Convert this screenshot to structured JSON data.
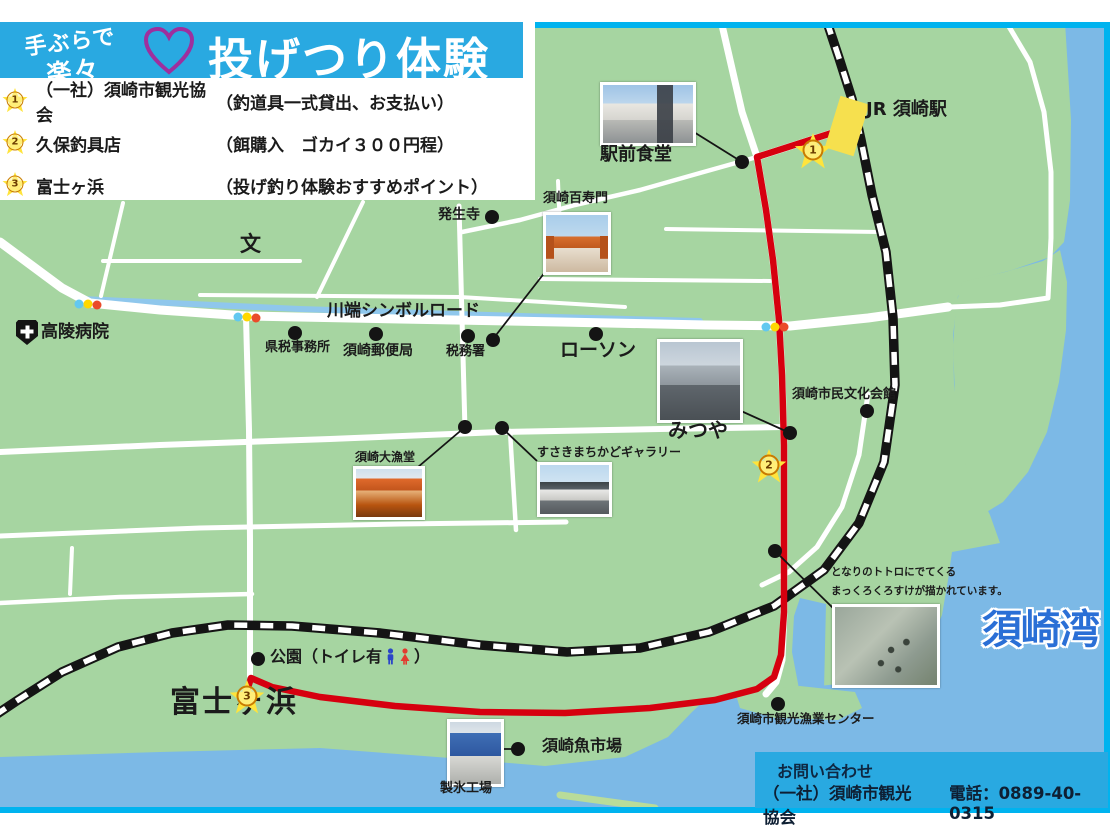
{
  "banner": {
    "tagline_line1": "手ぶらで",
    "tagline_line2": "楽々",
    "title": "投げつり体験",
    "heart_icon": "heart-outline"
  },
  "legend": {
    "items": [
      {
        "num": "1",
        "name": "（一社）須崎市観光協会",
        "note": "（釣道具一式貸出、お支払い）"
      },
      {
        "num": "2",
        "name": "久保釣具店",
        "note": "（餌購入　ゴカイ３００円程）"
      },
      {
        "num": "3",
        "name": "富士ヶ浜",
        "note": "（投げ釣り体験おすすめポイント）"
      }
    ]
  },
  "map": {
    "station_label": "JR 須崎駅",
    "road_label": "川端シンボルロード",
    "bay_label": "須崎湾",
    "hospital_label": "高陵病院",
    "school_mark": "文",
    "beach_label": "富士ヶ浜",
    "park_prefix": "公園（トイレ有",
    "park_suffix": "）",
    "stars": [
      "1",
      "2",
      "3"
    ],
    "pois": {
      "ekimae_shokudo": "駅前食堂",
      "hasshoji": "発生寺",
      "hyakujumon": "須崎百寿門",
      "kenzei": "県税事務所",
      "yubinkyoku": "須崎郵便局",
      "zeimusho": "税務署",
      "lawson": "ローソン",
      "mitsuya": "みつや",
      "bunka_kaikan": "須崎市民文化会館",
      "tairyodo": "須崎大漁堂",
      "gallery": "すさきまちかどギャラリー",
      "uoichiba": "須崎魚市場",
      "seihyo": "製氷工場",
      "gyogyo_center": "須崎市観光漁業センター"
    },
    "totoro_note": {
      "line1": "となりのトトロにでてくる",
      "line2": "まっくろくろすけが描かれています。"
    }
  },
  "contact": {
    "heading": "お問い合わせ",
    "org": "（一社）須崎市観光協会",
    "phone": "電話：0889-40-0315"
  },
  "icons": {
    "heart": "heart-outline",
    "hospital": "hospital-cross",
    "toilet_male": "male-figure",
    "toilet_female": "female-figure",
    "traffic_light": "traffic-light-dots"
  },
  "colors": {
    "land": "#a6d5a1",
    "water": "#7cb9e6",
    "frame_cyan": "#00b3ef",
    "banner_blue": "#29a9e1",
    "route_red": "#d6000f",
    "star_yellow": "#ffe43c",
    "station_yellow": "#f6e04e",
    "bay_text_blue": "#2a6fd6"
  }
}
